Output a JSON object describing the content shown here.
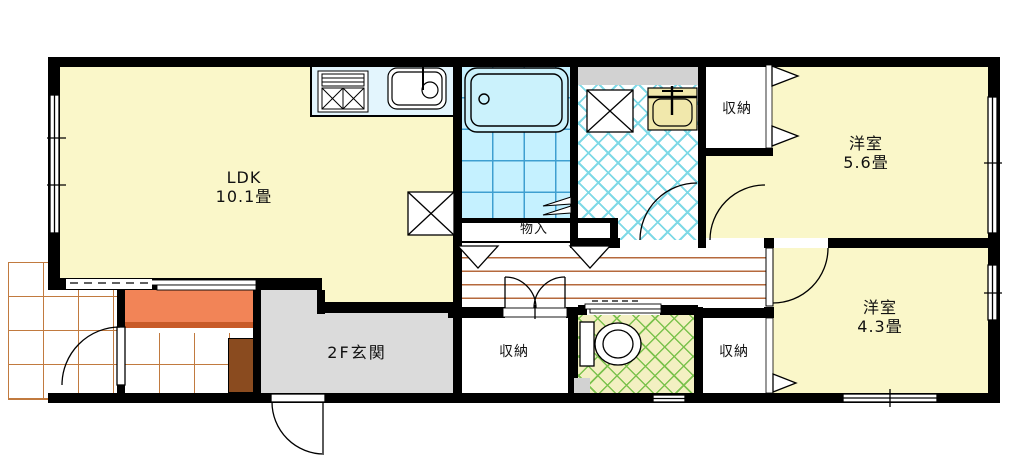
{
  "floorplan": {
    "rooms": {
      "ldk": {
        "name": "LDK",
        "size": "10.1畳"
      },
      "western_room_north": {
        "name": "洋室",
        "size": "5.6畳"
      },
      "western_room_south": {
        "name": "洋室",
        "size": "4.3畳"
      },
      "entrance_hall": {
        "name": "2F玄関"
      },
      "closet_north": {
        "name": "収納"
      },
      "closet_center": {
        "name": "収納"
      },
      "closet_southeast": {
        "name": "収納"
      },
      "storage_nook": {
        "name": "物入"
      }
    },
    "fixtures": [
      "kitchen-stove",
      "kitchen-sink",
      "bathtub",
      "washbasin",
      "washing-machine-space",
      "refrigerator-space",
      "toilet"
    ],
    "colors": {
      "wall": "#000000",
      "room_yellow": "#FAF7C9",
      "kitchen_counter": "#E3F5FD",
      "bath_floor": "#C5F1FF",
      "bath_grid": "#3E9FD0",
      "washroom_hatch": "#7FD9E6",
      "toilet_bg": "#F3F0C2",
      "toilet_hatch": "#7CC24E",
      "entrance_gray": "#DBDBDB",
      "pipe_space_gray": "#D2D2D2",
      "step_orange": "#F28457",
      "wood_line_brown": "#B5693C",
      "tile_line_orange": "#C17A3F",
      "cabinet_brown": "#8A4B1F",
      "washbasin_cream": "#F1E8AC"
    }
  }
}
